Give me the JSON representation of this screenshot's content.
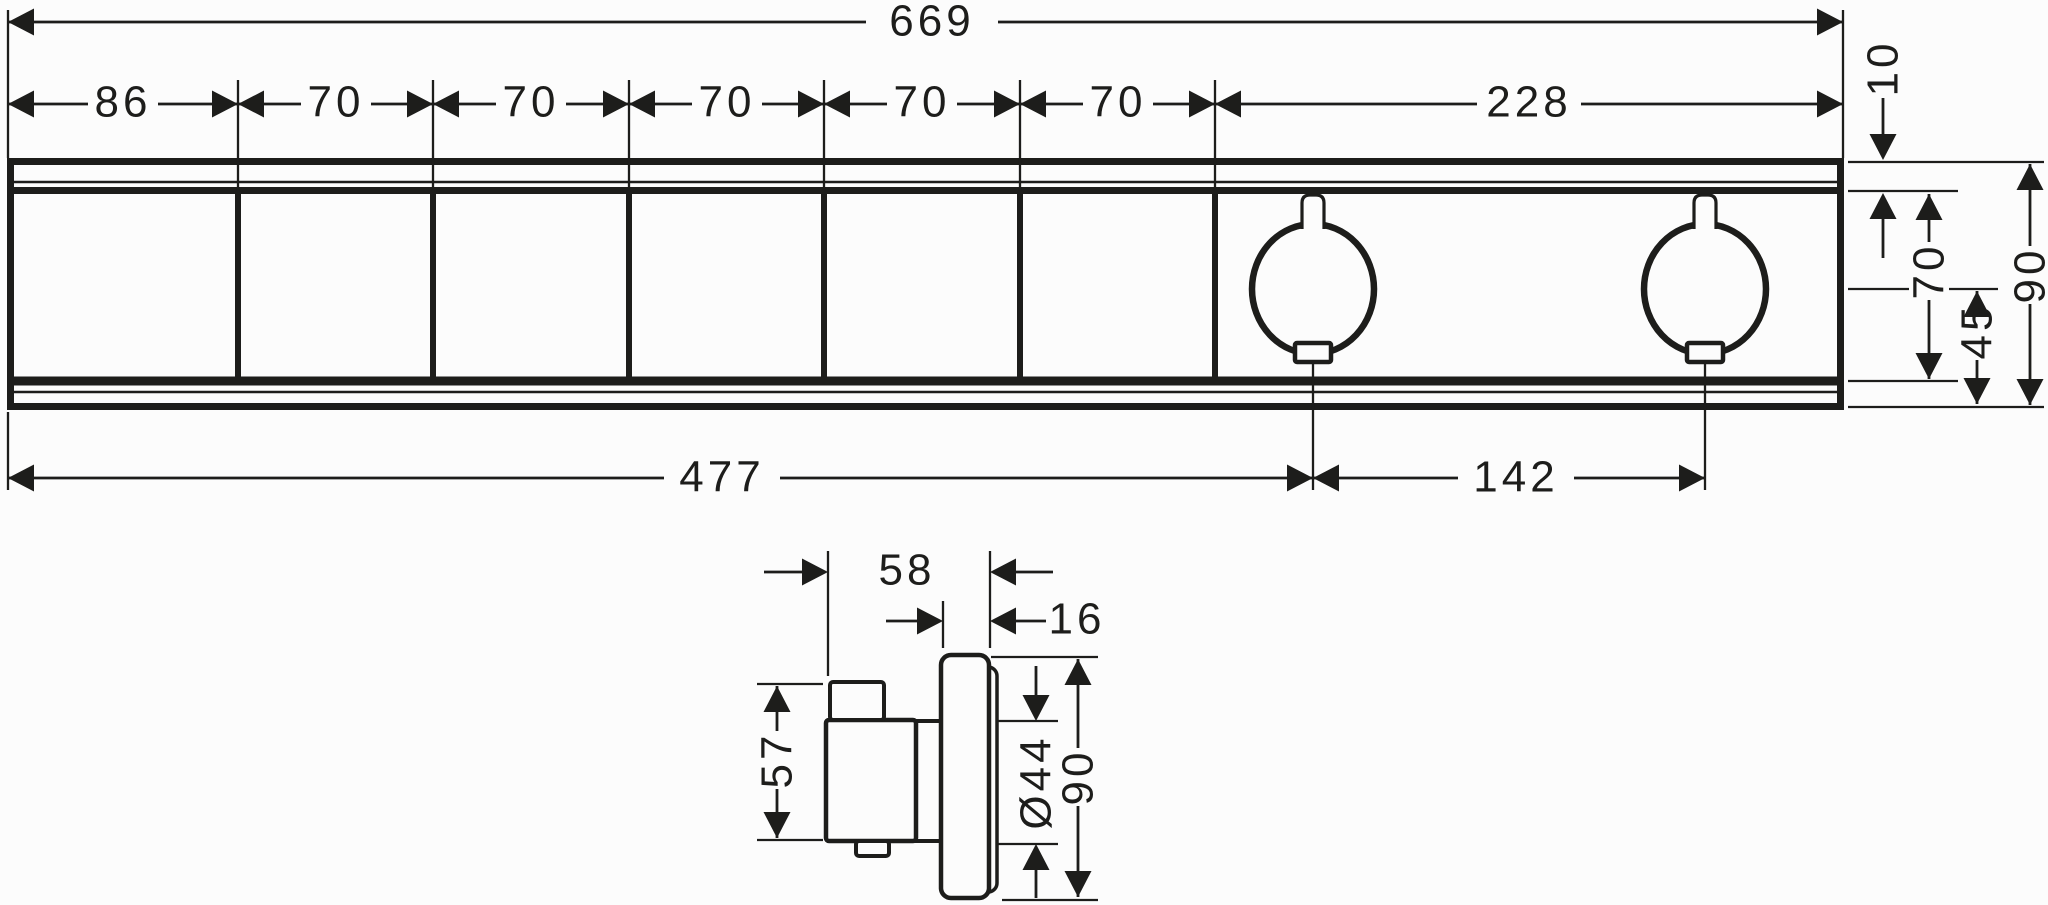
{
  "front_view": {
    "total_width": "669",
    "segments": [
      "86",
      "70",
      "70",
      "70",
      "70",
      "70",
      "228"
    ],
    "top_rail_depth": "10",
    "body_height": "70",
    "knob_center_to_bottom": "45",
    "total_height": "90",
    "left_edge_to_first_knob": "477",
    "knob_spacing": "142"
  },
  "side_view": {
    "total_depth": "58",
    "escutcheon_thickness": "16",
    "body_height": "57",
    "knob_diameter": "Ø44",
    "escutcheon_height": "90"
  }
}
